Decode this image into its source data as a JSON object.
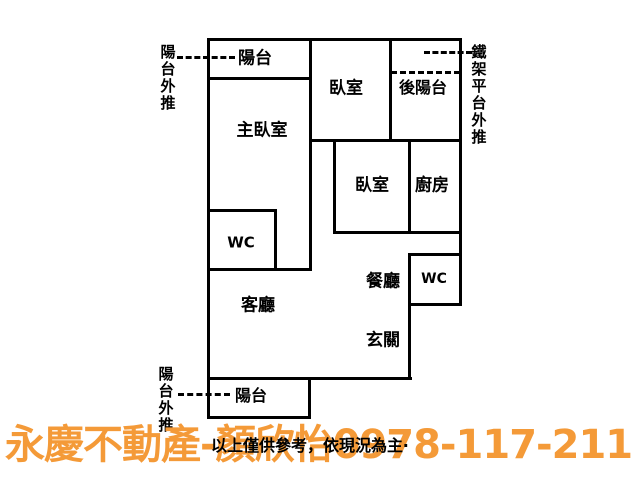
{
  "canvas": {
    "width": 640,
    "height": 480,
    "background": "#ffffff"
  },
  "colors": {
    "wall": "#000000",
    "text": "#000000",
    "agent_orange": "#F49A38"
  },
  "rooms": [
    {
      "id": "balcony-top",
      "label": "陽台",
      "cx": 255,
      "cy": 59,
      "size": 17
    },
    {
      "id": "master-bedroom",
      "label": "主臥室",
      "cx": 262,
      "cy": 131,
      "size": 17
    },
    {
      "id": "bedroom-1",
      "label": "臥室",
      "cx": 346,
      "cy": 89,
      "size": 17
    },
    {
      "id": "rear-balcony",
      "label": "後陽台",
      "cx": 423,
      "cy": 88,
      "size": 16
    },
    {
      "id": "bedroom-2",
      "label": "臥室",
      "cx": 372,
      "cy": 186,
      "size": 17
    },
    {
      "id": "kitchen",
      "label": "廚房",
      "cx": 432,
      "cy": 186,
      "size": 17
    },
    {
      "id": "wc-left",
      "label": "WC",
      "cx": 241,
      "cy": 243,
      "size": 15
    },
    {
      "id": "living-room",
      "label": "客廳",
      "cx": 258,
      "cy": 306,
      "size": 17
    },
    {
      "id": "dining-room",
      "label": "餐廳",
      "cx": 383,
      "cy": 282,
      "size": 17
    },
    {
      "id": "wc-right",
      "label": "WC",
      "cx": 434,
      "cy": 279,
      "size": 14
    },
    {
      "id": "foyer",
      "label": "玄關",
      "cx": 383,
      "cy": 341,
      "size": 17
    },
    {
      "id": "balcony-bottom",
      "label": "陽台",
      "cx": 251,
      "cy": 396,
      "size": 16
    }
  ],
  "annotations": [
    {
      "id": "balcony-pushout-top",
      "text": "陽台外推",
      "x": 159,
      "y": 44,
      "size": 15
    },
    {
      "id": "iron-platform-pushout",
      "text": "鐵架平台外推",
      "x": 470,
      "y": 44,
      "size": 15
    },
    {
      "id": "balcony-pushout-bottom",
      "text": "陽台外推",
      "x": 157,
      "y": 366,
      "size": 15
    }
  ],
  "floorplan": {
    "walls": [
      {
        "x": 207,
        "y": 38,
        "w": 255,
        "h": 3
      },
      {
        "x": 207,
        "y": 77,
        "w": 105,
        "h": 3
      },
      {
        "x": 309,
        "y": 139,
        "w": 153,
        "h": 3
      },
      {
        "x": 333,
        "y": 231,
        "w": 129,
        "h": 3
      },
      {
        "x": 409,
        "y": 253,
        "w": 53,
        "h": 3
      },
      {
        "x": 409,
        "y": 303,
        "w": 53,
        "h": 3
      },
      {
        "x": 207,
        "y": 209,
        "w": 70,
        "h": 3
      },
      {
        "x": 207,
        "y": 268,
        "w": 105,
        "h": 3
      },
      {
        "x": 207,
        "y": 377,
        "w": 205,
        "h": 3
      },
      {
        "x": 207,
        "y": 416,
        "w": 104,
        "h": 3
      },
      {
        "x": 207,
        "y": 38,
        "w": 3,
        "h": 381
      },
      {
        "x": 459,
        "y": 38,
        "w": 3,
        "h": 268
      },
      {
        "x": 309,
        "y": 38,
        "w": 3,
        "h": 233
      },
      {
        "x": 389,
        "y": 38,
        "w": 3,
        "h": 104
      },
      {
        "x": 333,
        "y": 139,
        "w": 3,
        "h": 95
      },
      {
        "x": 408,
        "y": 139,
        "w": 3,
        "h": 95
      },
      {
        "x": 408,
        "y": 253,
        "w": 3,
        "h": 127
      },
      {
        "x": 274,
        "y": 209,
        "w": 3,
        "h": 62
      },
      {
        "x": 308,
        "y": 377,
        "w": 3,
        "h": 42
      }
    ],
    "dashed_lines": [
      {
        "x": 177,
        "y": 56,
        "w": 58
      },
      {
        "x": 424,
        "y": 51,
        "w": 48
      },
      {
        "x": 391,
        "y": 71,
        "w": 69
      },
      {
        "x": 178,
        "y": 393,
        "w": 52
      }
    ]
  },
  "footer": {
    "disclaimer": "以上僅供參考，依現況為主‧",
    "agent_line": "永慶不動產-顏欣怡0978-117-211"
  }
}
